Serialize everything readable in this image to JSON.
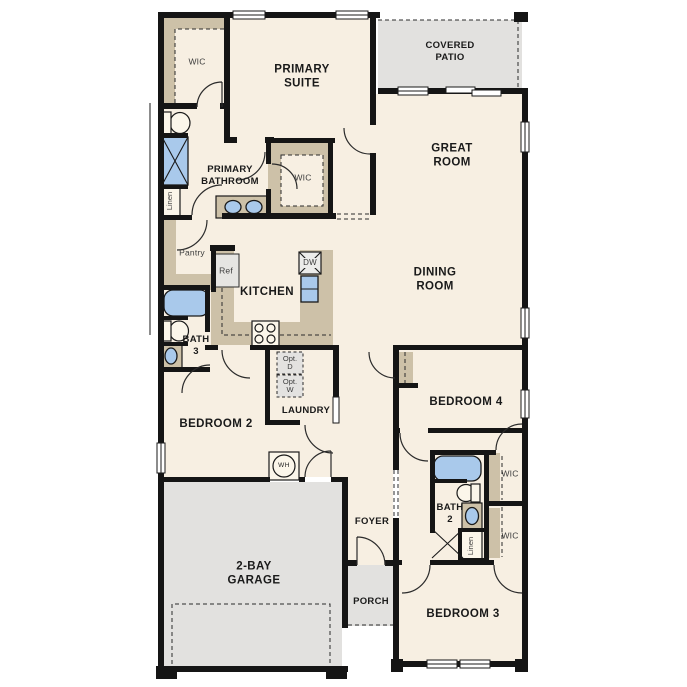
{
  "colors": {
    "floor": "#f7efe2",
    "cabinet_tan": "#cdc1a8",
    "outdoor_gray": "#e2e1df",
    "fixture_blue": "#a9c9eb",
    "wall": "#151515",
    "label": "#1a1a1a"
  },
  "rooms": {
    "wic_primary_1": {
      "label": "WIC"
    },
    "primary_suite": {
      "line1": "PRIMARY",
      "line2": "SUITE"
    },
    "covered_patio": {
      "line1": "COVERED",
      "line2": "PATIO"
    },
    "great_room": {
      "line1": "GREAT",
      "line2": "ROOM"
    },
    "primary_bathroom": {
      "line1": "PRIMARY",
      "line2": "BATHROOM"
    },
    "wic_primary_2": {
      "label": "WIC"
    },
    "linen_1": {
      "label": "Linen"
    },
    "pantry": {
      "label": "Pantry"
    },
    "kitchen": {
      "label": "KITCHEN"
    },
    "dining_room": {
      "line1": "DINING",
      "line2": "ROOM"
    },
    "bath_3": {
      "line1": "BATH",
      "line2": "3"
    },
    "bedroom_2": {
      "label": "BEDROOM 2"
    },
    "laundry": {
      "label": "LAUNDRY"
    },
    "bedroom_4": {
      "label": "BEDROOM 4"
    },
    "foyer": {
      "label": "FOYER"
    },
    "bath_2": {
      "line1": "BATH",
      "line2": "2"
    },
    "wic_bedroom_4": {
      "label": "WIC"
    },
    "wic_bedroom_3": {
      "label": "WIC"
    },
    "linen_2": {
      "label": "Linen"
    },
    "porch": {
      "label": "PORCH"
    },
    "garage": {
      "line1": "2-BAY",
      "line2": "GARAGE"
    },
    "bedroom_3": {
      "label": "BEDROOM 3"
    }
  },
  "fixtures": {
    "refrigerator": {
      "label": "Ref"
    },
    "dishwasher": {
      "label": "DW"
    },
    "water_heater": {
      "label": "WH"
    },
    "optional_dryer": {
      "line1": "Opt.",
      "line2": "D"
    },
    "optional_washer": {
      "line1": "Opt.",
      "line2": "W"
    }
  }
}
